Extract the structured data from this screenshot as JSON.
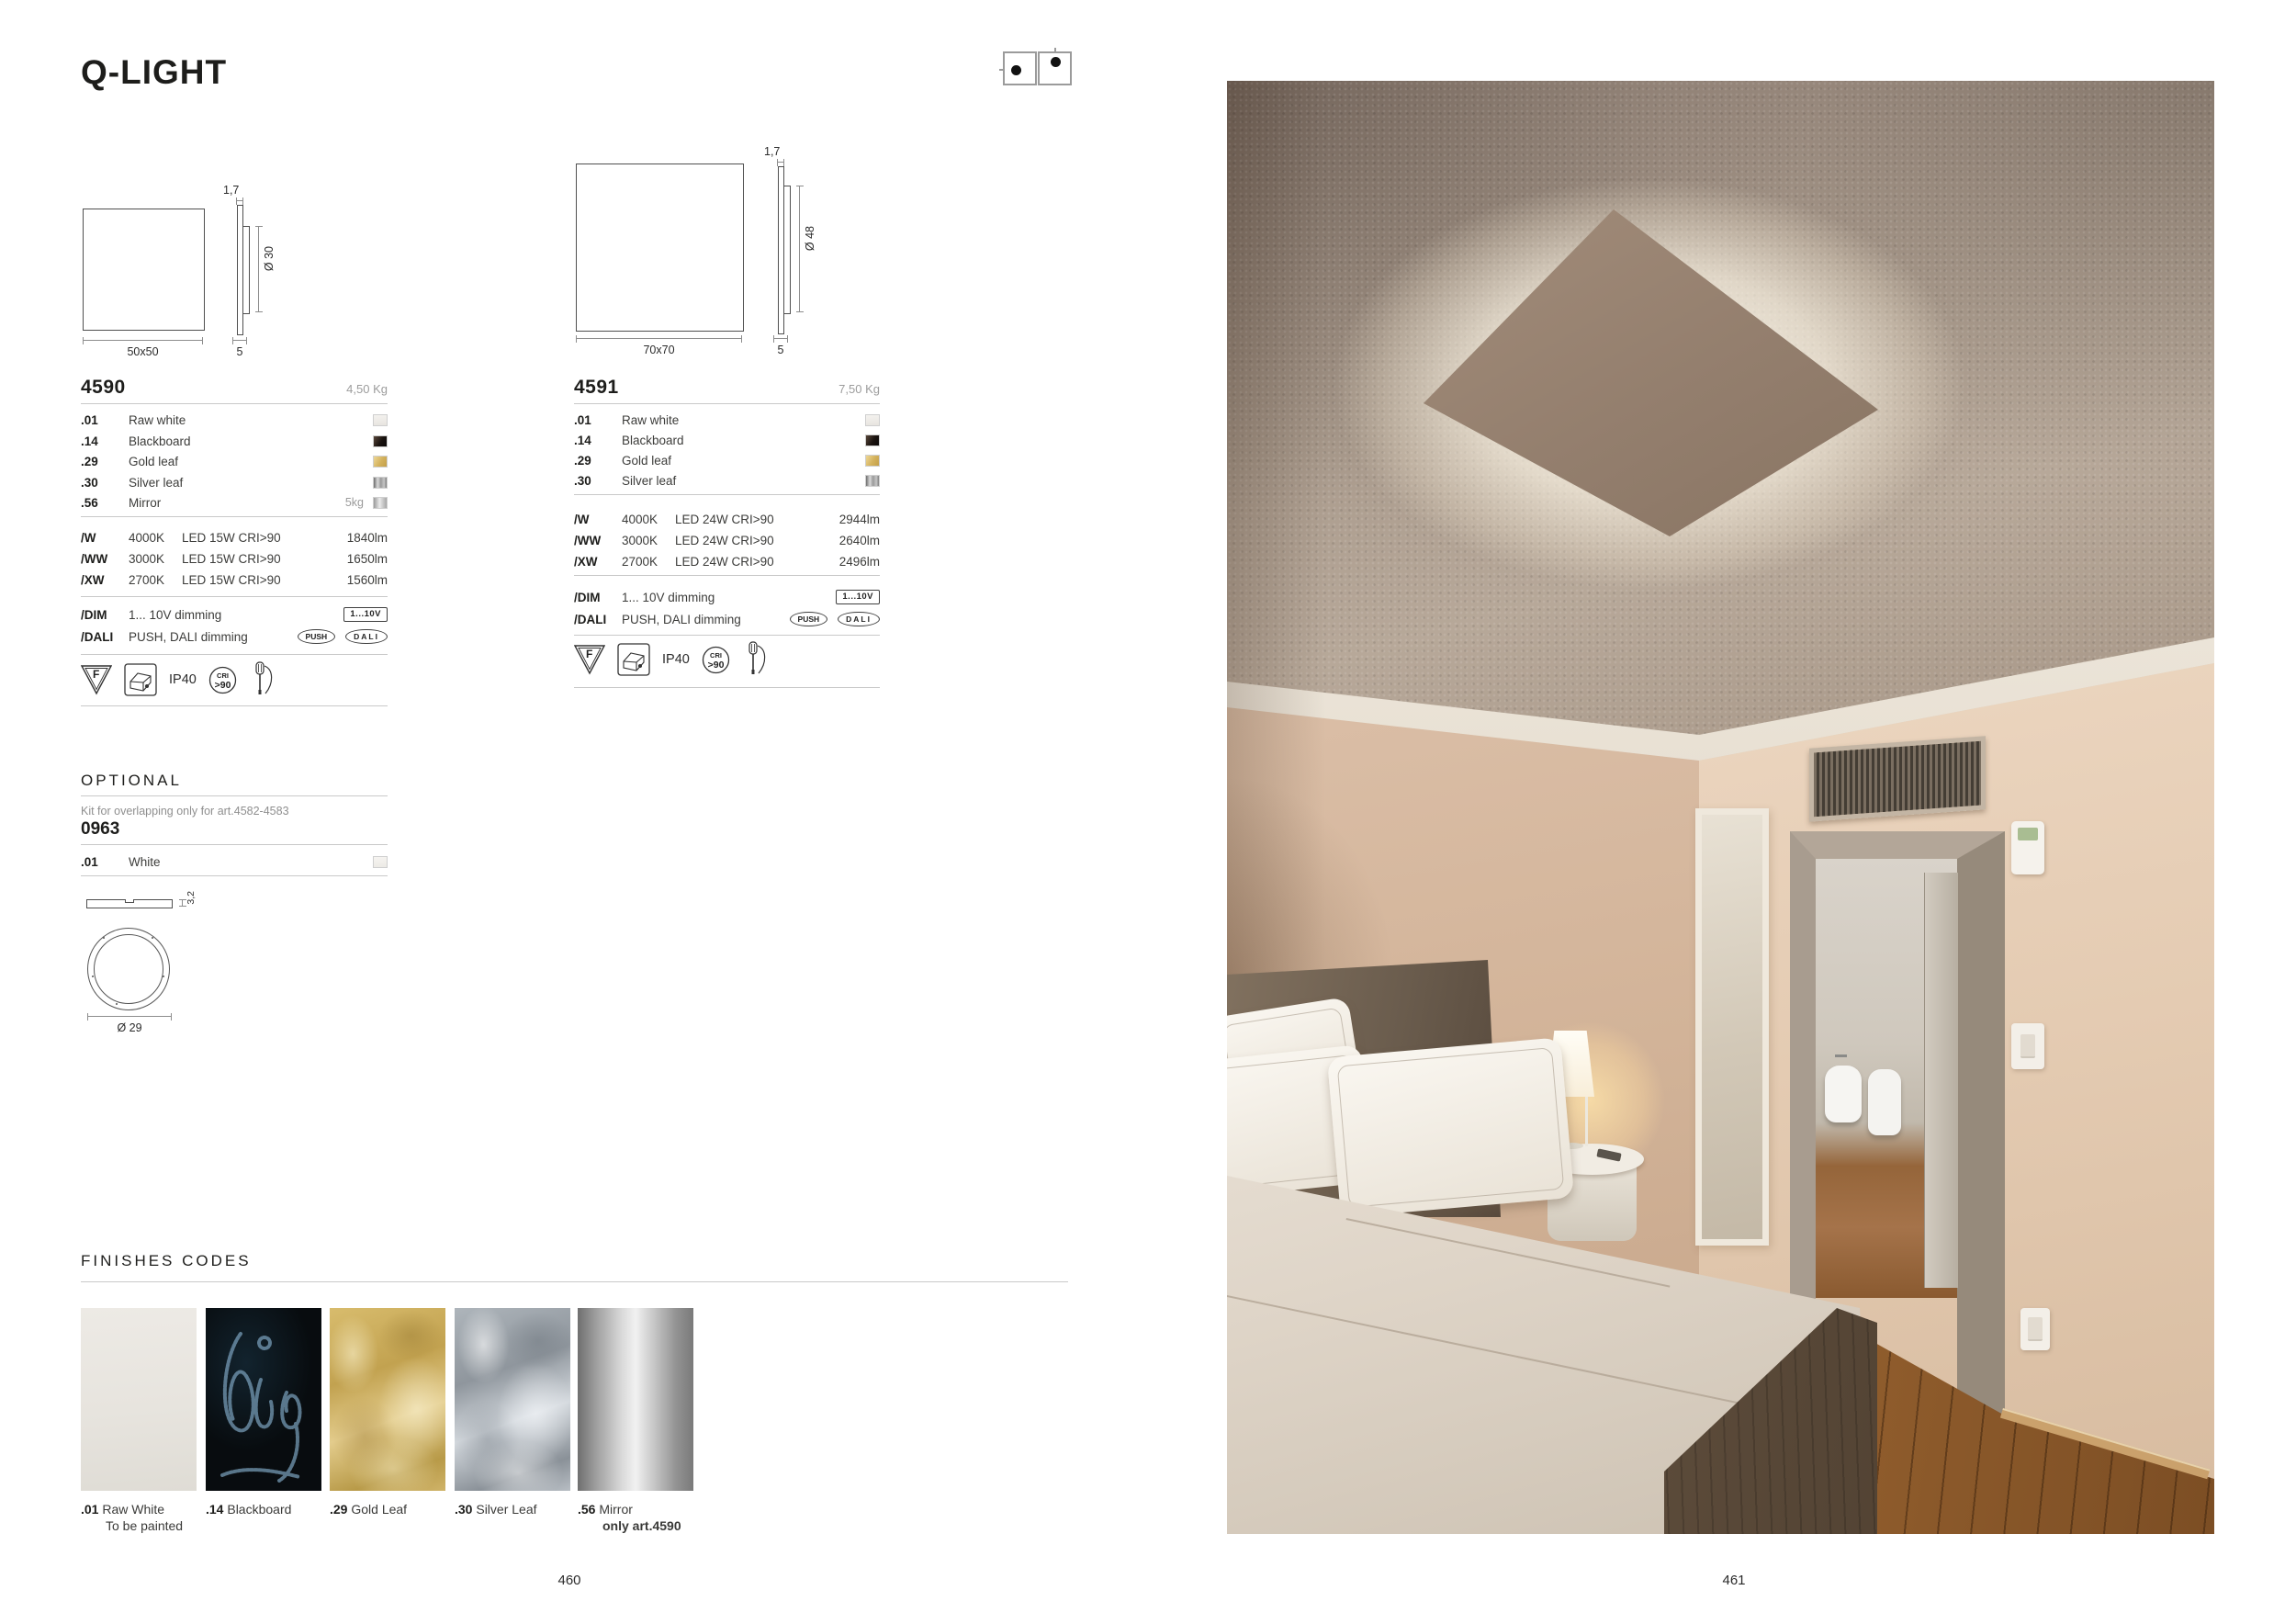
{
  "page": {
    "title": "Q-LIGHT",
    "page_number_left": "460",
    "page_number_right": "461"
  },
  "mounting_icons": [
    "wall-mount",
    "ceiling-mount"
  ],
  "products": [
    {
      "code": "4590",
      "weight": "4,50 Kg",
      "drawing": {
        "front": "50x50",
        "thickness": "1,7",
        "inner": "Ø 30",
        "depth": "5"
      },
      "finishes": [
        {
          "code": ".01",
          "label": "Raw white",
          "note": "",
          "swatch": "raw-white"
        },
        {
          "code": ".14",
          "label": "Blackboard",
          "note": "",
          "swatch": "blackboard"
        },
        {
          "code": ".29",
          "label": "Gold leaf",
          "note": "",
          "swatch": "gold-leaf"
        },
        {
          "code": ".30",
          "label": "Silver leaf",
          "note": "",
          "swatch": "silver-leaf"
        },
        {
          "code": ".56",
          "label": "Mirror",
          "note": "5kg",
          "swatch": "mirror"
        }
      ],
      "led_options": [
        {
          "code": "/W",
          "temp": "4000K",
          "spec": "LED 15W CRI>90",
          "lumen": "1840lm"
        },
        {
          "code": "/WW",
          "temp": "3000K",
          "spec": "LED 15W CRI>90",
          "lumen": "1650lm"
        },
        {
          "code": "/XW",
          "temp": "2700K",
          "spec": "LED 15W CRI>90",
          "lumen": "1560lm"
        }
      ],
      "dimming": [
        {
          "code": "/DIM",
          "label": "1... 10V dimming",
          "badges": [
            "1...10V"
          ]
        },
        {
          "code": "/DALI",
          "label": "PUSH, DALI dimming",
          "badges": [
            "PUSH",
            "DALI"
          ]
        }
      ],
      "cert": {
        "class": "F",
        "ip": "IP40",
        "cri_top": "CRI",
        "cri_bottom": ">90"
      }
    },
    {
      "code": "4591",
      "weight": "7,50 Kg",
      "drawing": {
        "front": "70x70",
        "thickness": "1,7",
        "inner": "Ø 48",
        "depth": "5"
      },
      "finishes": [
        {
          "code": ".01",
          "label": "Raw white",
          "note": "",
          "swatch": "raw-white"
        },
        {
          "code": ".14",
          "label": "Blackboard",
          "note": "",
          "swatch": "blackboard"
        },
        {
          "code": ".29",
          "label": "Gold leaf",
          "note": "",
          "swatch": "gold-leaf"
        },
        {
          "code": ".30",
          "label": "Silver leaf",
          "note": "",
          "swatch": "silver-leaf"
        }
      ],
      "led_options": [
        {
          "code": "/W",
          "temp": "4000K",
          "spec": "LED 24W CRI>90",
          "lumen": "2944lm"
        },
        {
          "code": "/WW",
          "temp": "3000K",
          "spec": "LED 24W CRI>90",
          "lumen": "2640lm"
        },
        {
          "code": "/XW",
          "temp": "2700K",
          "spec": "LED 24W CRI>90",
          "lumen": "2496lm"
        }
      ],
      "dimming": [
        {
          "code": "/DIM",
          "label": "1... 10V dimming",
          "badges": [
            "1...10V"
          ]
        },
        {
          "code": "/DALI",
          "label": "PUSH, DALI dimming",
          "badges": [
            "PUSH",
            "DALI"
          ]
        }
      ],
      "cert": {
        "class": "F",
        "ip": "IP40",
        "cri_top": "CRI",
        "cri_bottom": ">90"
      }
    }
  ],
  "optional": {
    "heading": "OPTIONAL",
    "note": "Kit for overlapping only for art.4582-4583",
    "code": "0963",
    "finishes": [
      {
        "code": ".01",
        "label": "White",
        "swatch": "white"
      }
    ],
    "drawing": {
      "thickness": "3,2",
      "diameter": "Ø 29"
    }
  },
  "finishes_codes": {
    "heading": "FINISHES CODES",
    "items": [
      {
        "code": ".01",
        "label": "Raw White",
        "sublabel": "To be painted",
        "swatch": "raw-white"
      },
      {
        "code": ".14",
        "label": "Blackboard",
        "sublabel": "",
        "swatch": "blackboard"
      },
      {
        "code": ".29",
        "label": "Gold Leaf",
        "sublabel": "",
        "swatch": "gold-leaf"
      },
      {
        "code": ".30",
        "label": "Silver Leaf",
        "sublabel": "",
        "swatch": "silver-leaf"
      },
      {
        "code": ".56",
        "label": "Mirror",
        "sublabel": "only art.4590",
        "swatch": "mirror"
      }
    ]
  },
  "colors": {
    "accent_gold": "#d3b15c",
    "accent_silver": "#9a9a9a",
    "wall_beige": "#e4cbb2",
    "wood_floor": "#a96f38",
    "rule_gray": "#c9c9c9"
  }
}
